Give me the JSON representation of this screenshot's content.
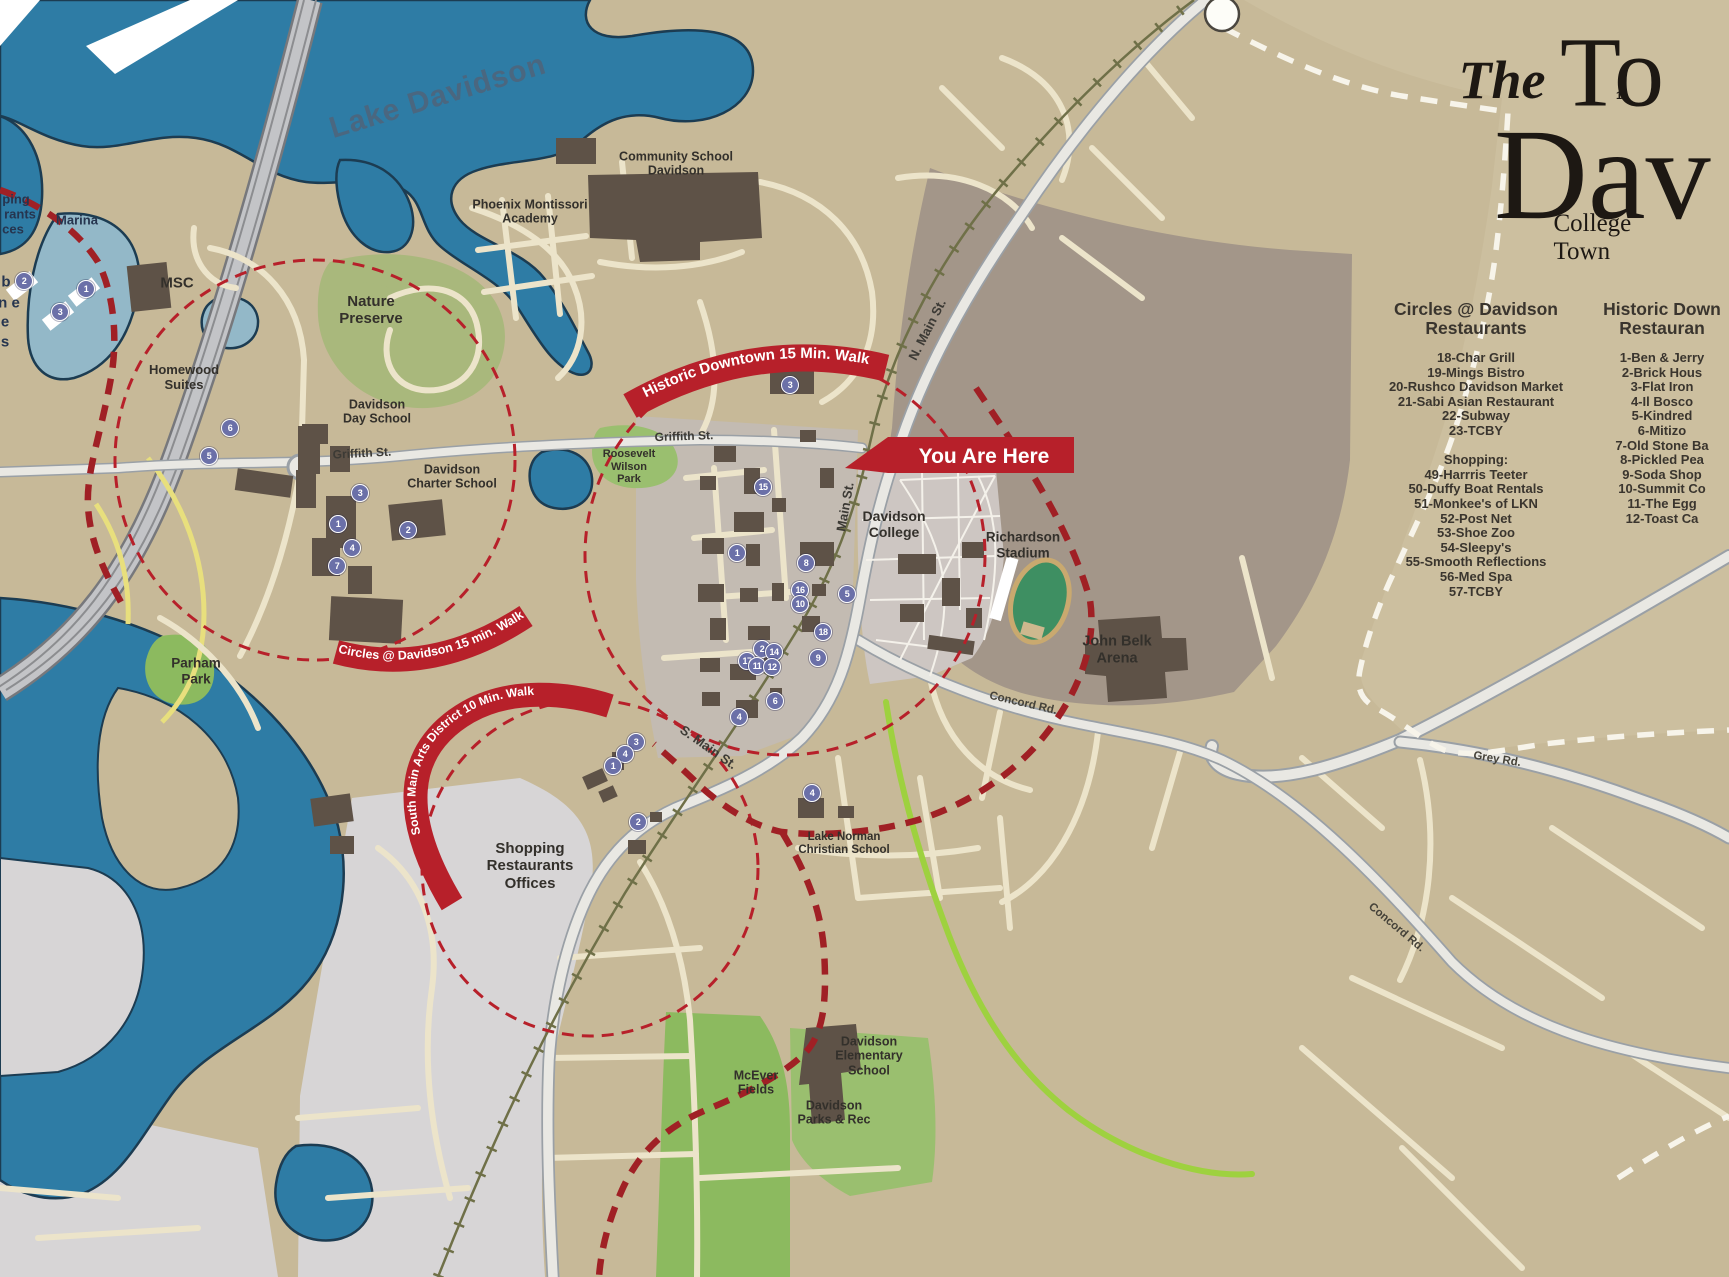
{
  "title": {
    "the": "The",
    "town": "To",
    "main": "Dav",
    "superscript": "14",
    "subtitle": "College Town"
  },
  "banners": {
    "you_are_here": "You Are Here",
    "historic_walk": "Historic Downtown 15 Min. Walk",
    "circles_walk": "Circles @ Davidson 15 min. Walk",
    "south_main_walk": "South Main Arts District 10 Min. Walk"
  },
  "legend": {
    "circles": {
      "header_line1": "Circles @ Davidson",
      "header_line2": "Restaurants",
      "items": [
        "18-Char Grill",
        "19-Mings Bistro",
        "20-Rushco Davidson Market",
        "21-Sabi Asian Restaurant",
        "22-Subway",
        "23-TCBY",
        "",
        "Shopping:",
        "49-Harrris Teeter",
        "50-Duffy Boat Rentals",
        "51-Monkee's of LKN",
        "52-Post Net",
        "53-Shoe Zoo",
        "54-Sleepy's",
        "55-Smooth Reflections",
        "56-Med Spa",
        "57-TCBY"
      ]
    },
    "historic": {
      "header_line1": "Historic Down",
      "header_line2": "Restauran",
      "items": [
        "1-Ben & Jerry",
        "2-Brick Hous",
        "3-Flat Iron",
        "4-Il Bosco",
        "5-Kindred",
        "6-Mitizo",
        "7-Old Stone Ba",
        "8-Pickled Pea",
        "9-Soda Shop",
        "10-Summit Co",
        "11-The Egg",
        "12-Toast Ca"
      ]
    }
  },
  "map_labels": [
    {
      "name": "lake-davidson-label",
      "text": "Lake Davidson",
      "x": 438,
      "y": 97,
      "size": 30,
      "rot": -17,
      "color": "#4a6780",
      "ls": 1
    },
    {
      "name": "marina-label",
      "text": "Marina",
      "x": 77,
      "y": 221,
      "size": 13,
      "color": "#26354f"
    },
    {
      "name": "edge-fragment-ping",
      "text": "ping",
      "x": 16,
      "y": 200,
      "size": 13,
      "color": "#26354f"
    },
    {
      "name": "edge-fragment-rants",
      "text": "rants",
      "x": 20,
      "y": 215,
      "size": 13,
      "color": "#26354f"
    },
    {
      "name": "edge-fragment-ces",
      "text": "ces",
      "x": 13,
      "y": 230,
      "size": 13,
      "color": "#26354f"
    },
    {
      "name": "edge-fragment-b",
      "text": "b",
      "x": 6,
      "y": 282,
      "size": 15,
      "color": "#26354f"
    },
    {
      "name": "edge-fragment-ne",
      "text": "n e",
      "x": 9,
      "y": 303,
      "size": 15,
      "color": "#26354f"
    },
    {
      "name": "edge-fragment-e",
      "text": "e",
      "x": 5,
      "y": 322,
      "size": 15,
      "color": "#26354f"
    },
    {
      "name": "edge-fragment-s",
      "text": "s",
      "x": 5,
      "y": 342,
      "size": 15,
      "color": "#26354f"
    },
    {
      "name": "msc-label",
      "text": "MSC",
      "x": 177,
      "y": 283,
      "size": 15
    },
    {
      "name": "nature-preserve-label",
      "text": "Nature\nPreserve",
      "x": 371,
      "y": 310,
      "size": 15
    },
    {
      "name": "community-school-label",
      "text": "Community School\nDavidson",
      "x": 676,
      "y": 164,
      "size": 12.5
    },
    {
      "name": "phoenix-montissori-label",
      "text": "Phoenix Montissori\nAcademy",
      "x": 530,
      "y": 212,
      "size": 12.5
    },
    {
      "name": "homewood-suites-label",
      "text": "Homewood\nSuites",
      "x": 184,
      "y": 378,
      "size": 13
    },
    {
      "name": "davidson-day-school-label",
      "text": "Davidson\nDay School",
      "x": 377,
      "y": 412,
      "size": 12.5
    },
    {
      "name": "davidson-charter-school-label",
      "text": "Davidson\nCharter School",
      "x": 452,
      "y": 477,
      "size": 12.5
    },
    {
      "name": "griffith-st-west-label",
      "text": "Griffith St.",
      "x": 362,
      "y": 454,
      "size": 12,
      "rot": -3,
      "color": "#3c3a35"
    },
    {
      "name": "griffith-st-east-label",
      "text": "Griffith St.",
      "x": 684,
      "y": 437,
      "size": 12,
      "rot": -2,
      "color": "#3c3a35"
    },
    {
      "name": "roosevelt-wilson-park-label",
      "text": "Roosevelt\nWilson\nPark",
      "x": 629,
      "y": 467,
      "size": 11
    },
    {
      "name": "n-main-st-label",
      "text": "N. Main St.",
      "x": 928,
      "y": 330,
      "size": 13,
      "rot": -63,
      "color": "#3c3a35"
    },
    {
      "name": "main-st-label",
      "text": "Main St.",
      "x": 846,
      "y": 507,
      "size": 13,
      "rot": -80,
      "color": "#3c3a35"
    },
    {
      "name": "s-main-st-label",
      "text": "S. Main St.",
      "x": 708,
      "y": 748,
      "size": 13,
      "rot": 35,
      "color": "#3c3a35"
    },
    {
      "name": "davidson-college-label",
      "text": "Davidson\nCollege",
      "x": 894,
      "y": 524,
      "size": 14
    },
    {
      "name": "richardson-stadium-label",
      "text": "Richardson\nStadium",
      "x": 1023,
      "y": 545,
      "size": 13.5
    },
    {
      "name": "john-belk-arena-label",
      "text": "John Belk\nArena",
      "x": 1117,
      "y": 650,
      "size": 14.5
    },
    {
      "name": "parham-park-label",
      "text": "Parham\nPark",
      "x": 196,
      "y": 671,
      "size": 13.5
    },
    {
      "name": "shopping-district-label",
      "text": "Shopping\nRestaurants\nOffices",
      "x": 530,
      "y": 866,
      "size": 15
    },
    {
      "name": "lake-norman-christian-label",
      "text": "Lake Norman\nChristian School",
      "x": 844,
      "y": 844,
      "size": 11.5
    },
    {
      "name": "mcever-fields-label",
      "text": "McEver\nFields",
      "x": 756,
      "y": 1083,
      "size": 12.5
    },
    {
      "name": "davidson-elementary-label",
      "text": "Davidson\nElementary\nSchool",
      "x": 869,
      "y": 1056,
      "size": 12.5
    },
    {
      "name": "davidson-parks-rec-label",
      "text": "Davidson\nParks & Rec",
      "x": 834,
      "y": 1113,
      "size": 12.5
    },
    {
      "name": "concord-rd-label",
      "text": "Concord Rd.",
      "x": 1023,
      "y": 704,
      "size": 11.5,
      "rot": 13,
      "color": "#454239"
    },
    {
      "name": "grey-rd-label",
      "text": "Grey Rd.",
      "x": 1497,
      "y": 760,
      "size": 11.5,
      "rot": 9,
      "color": "#454239"
    },
    {
      "name": "concord-rd-label-2",
      "text": "Concord Rd.",
      "x": 1396,
      "y": 928,
      "size": 11.5,
      "rot": 40,
      "color": "#454239"
    }
  ],
  "markers": [
    {
      "n": "2",
      "x": 24,
      "y": 281
    },
    {
      "n": "1",
      "x": 86,
      "y": 289
    },
    {
      "n": "3",
      "x": 60,
      "y": 312
    },
    {
      "n": "6",
      "x": 230,
      "y": 428
    },
    {
      "n": "5",
      "x": 209,
      "y": 456
    },
    {
      "n": "3",
      "x": 360,
      "y": 493
    },
    {
      "n": "1",
      "x": 338,
      "y": 524
    },
    {
      "n": "2",
      "x": 408,
      "y": 530
    },
    {
      "n": "4",
      "x": 352,
      "y": 548
    },
    {
      "n": "7",
      "x": 337,
      "y": 566
    },
    {
      "n": "3",
      "x": 790,
      "y": 385
    },
    {
      "n": "15",
      "x": 763,
      "y": 487
    },
    {
      "n": "1",
      "x": 737,
      "y": 553
    },
    {
      "n": "8",
      "x": 806,
      "y": 563
    },
    {
      "n": "16",
      "x": 800,
      "y": 590
    },
    {
      "n": "10",
      "x": 800,
      "y": 604
    },
    {
      "n": "5",
      "x": 847,
      "y": 594
    },
    {
      "n": "18",
      "x": 823,
      "y": 632
    },
    {
      "n": "2",
      "x": 762,
      "y": 649
    },
    {
      "n": "14",
      "x": 774,
      "y": 652
    },
    {
      "n": "17",
      "x": 747,
      "y": 661
    },
    {
      "n": "11",
      "x": 757,
      "y": 666
    },
    {
      "n": "12",
      "x": 772,
      "y": 667
    },
    {
      "n": "9",
      "x": 818,
      "y": 658
    },
    {
      "n": "6",
      "x": 775,
      "y": 701
    },
    {
      "n": "4",
      "x": 739,
      "y": 717
    },
    {
      "n": "3",
      "x": 636,
      "y": 742
    },
    {
      "n": "4",
      "x": 625,
      "y": 754
    },
    {
      "n": "1",
      "x": 613,
      "y": 766
    },
    {
      "n": "2",
      "x": 638,
      "y": 822
    },
    {
      "n": "4",
      "x": 812,
      "y": 793
    }
  ],
  "colors": {
    "accent-red": "#b7202a",
    "boundary-red": "#a02025",
    "water-blue": "#2e7ca5",
    "marker-blue": "#6b70a8",
    "greenway-green": "#9ed13f"
  }
}
